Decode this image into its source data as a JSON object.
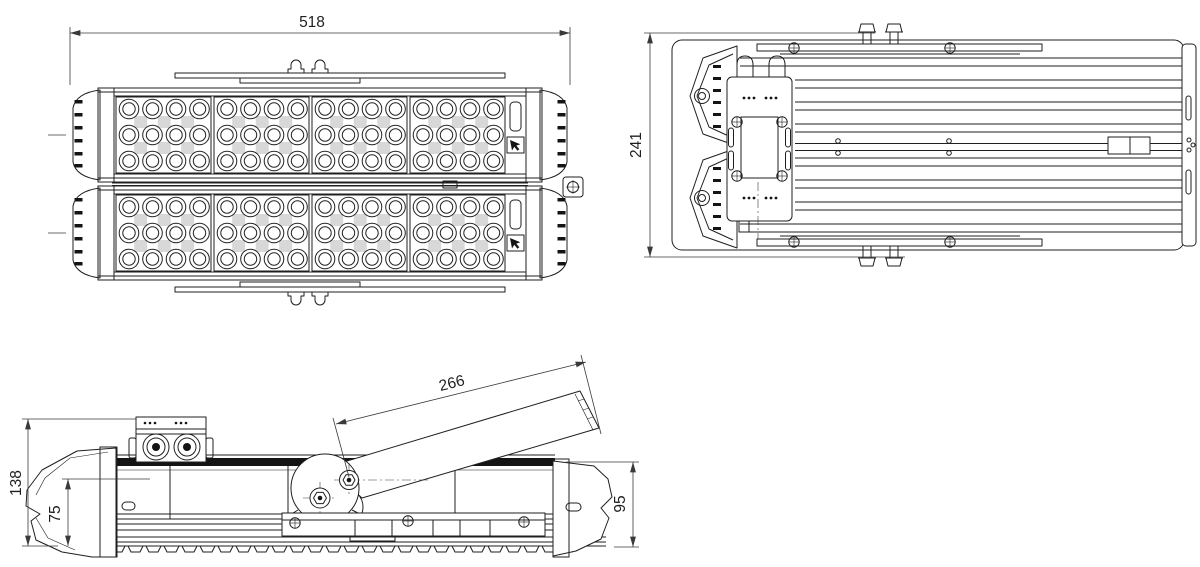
{
  "drawing": {
    "dimensions": {
      "front_width": "518",
      "overall_depth": "241",
      "arm_length": "266",
      "total_height": "138",
      "lower_height": "75",
      "housing_height": "95"
    },
    "colors": {
      "line": "#1f1f1f",
      "dim": "#3a3a3a",
      "pad": "#d8d8d8",
      "dark": "#141414",
      "bg": "#ffffff"
    }
  }
}
